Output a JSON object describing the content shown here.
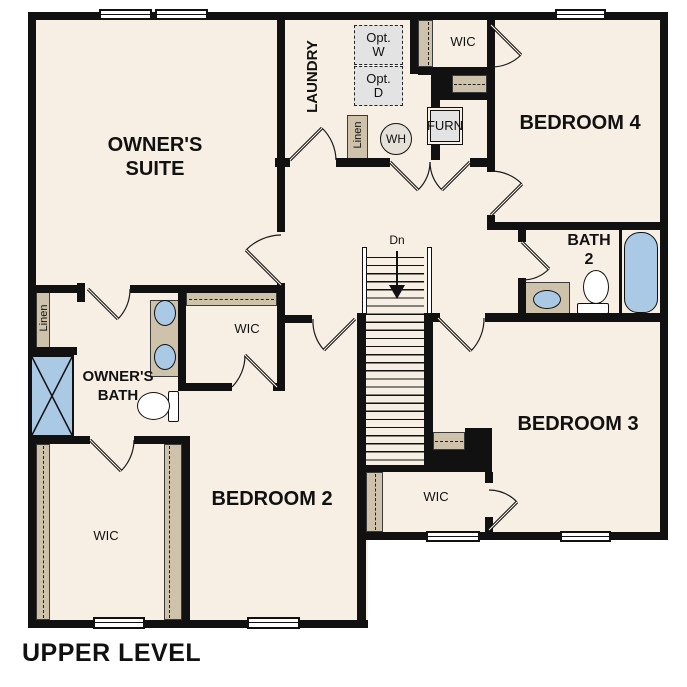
{
  "title": "UPPER LEVEL",
  "rooms": {
    "owners_suite": {
      "line1": "OWNER'S",
      "line2": "SUITE"
    },
    "laundry": "LAUNDRY",
    "bedroom4": "BEDROOM 4",
    "bedroom3": "BEDROOM 3",
    "bedroom2": "BEDROOM 2",
    "bath2": {
      "line1": "BATH",
      "line2": "2"
    },
    "owners_bath": {
      "line1": "OWNER'S",
      "line2": "BATH"
    },
    "wic": "WIC",
    "linen": "Linen"
  },
  "annotations": {
    "stairs_direction": "Dn",
    "water_heater": "WH",
    "furnace": "FURN",
    "opt_washer": {
      "line1": "Opt.",
      "line2": "W"
    },
    "opt_dryer": {
      "line1": "Opt.",
      "line2": "D"
    }
  },
  "colors": {
    "floor": "#f7efe3",
    "wall": "#111111",
    "closet_tan": "#cec3aa",
    "fixture_blue": "#a9c9e5",
    "option_gray": "#e3e3e3",
    "background": "#ffffff"
  }
}
